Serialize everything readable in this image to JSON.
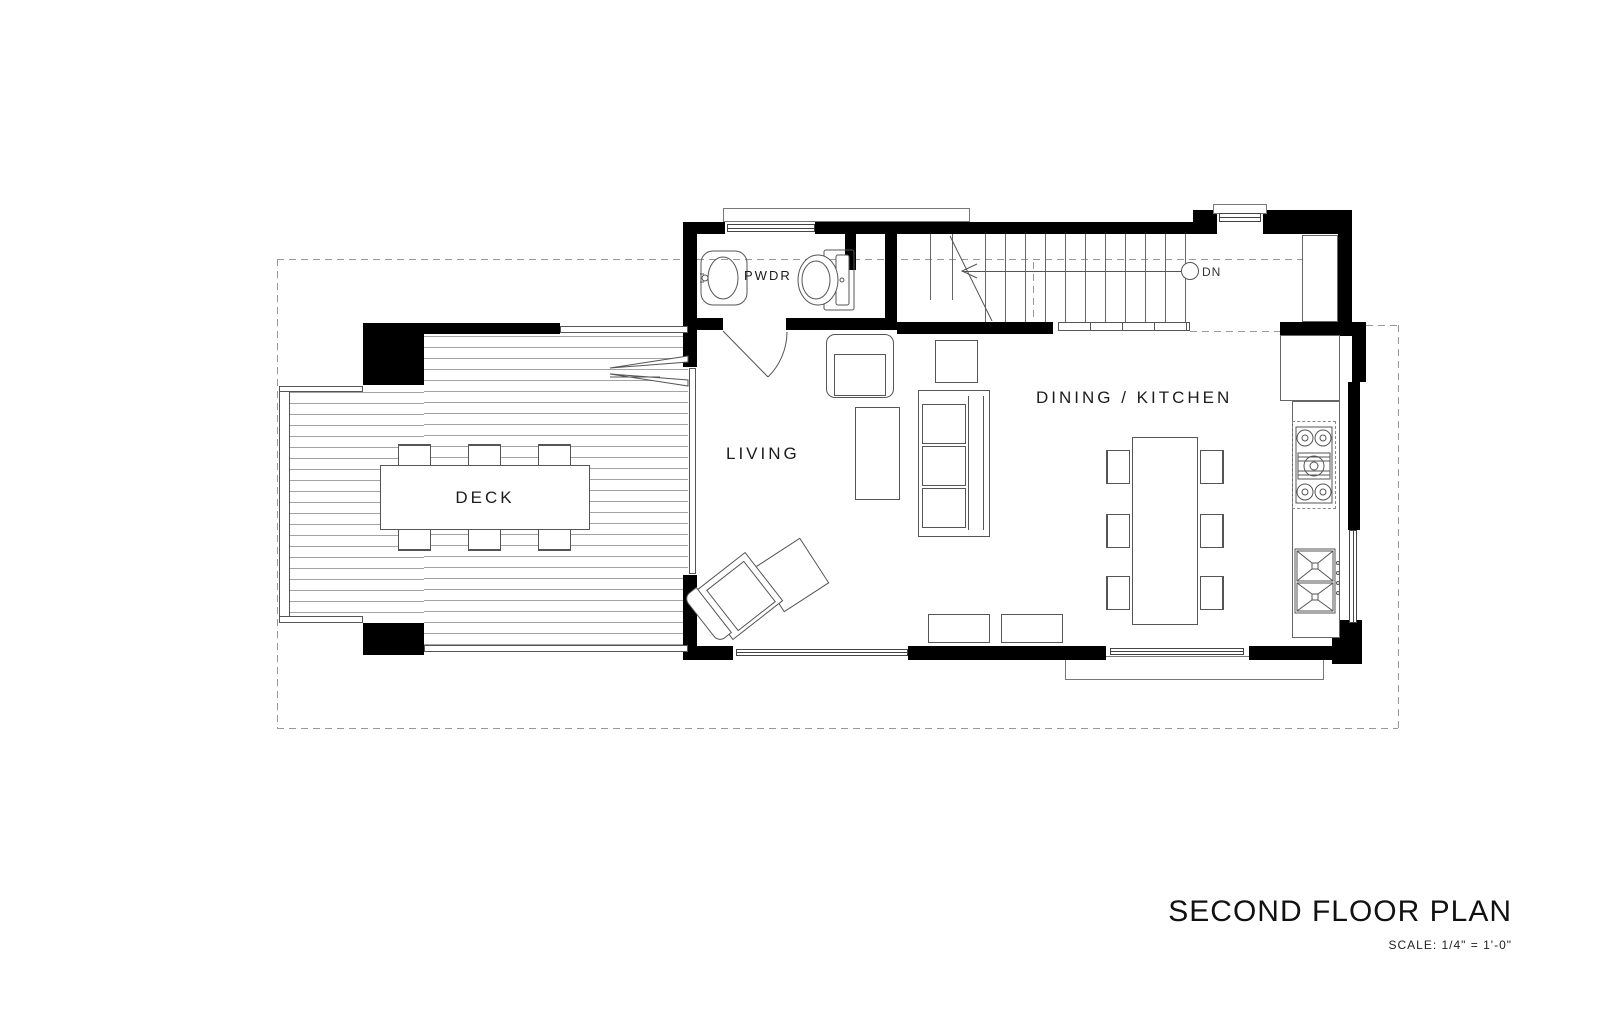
{
  "labels": {
    "powder_room": "PWDR",
    "living_room": "LIVING",
    "dining_kitchen": "DINING / KITCHEN",
    "deck": "DECK",
    "stair_direction": "DN"
  },
  "title_block": {
    "title": "SECOND FLOOR PLAN",
    "scale": "SCALE: 1/4\" =  1'-0\""
  },
  "colors": {
    "wall": "#000000",
    "furniture_line": "#555555",
    "dashed_line": "#999999",
    "plank_line": "#a3a3a3",
    "background": "#ffffff"
  }
}
